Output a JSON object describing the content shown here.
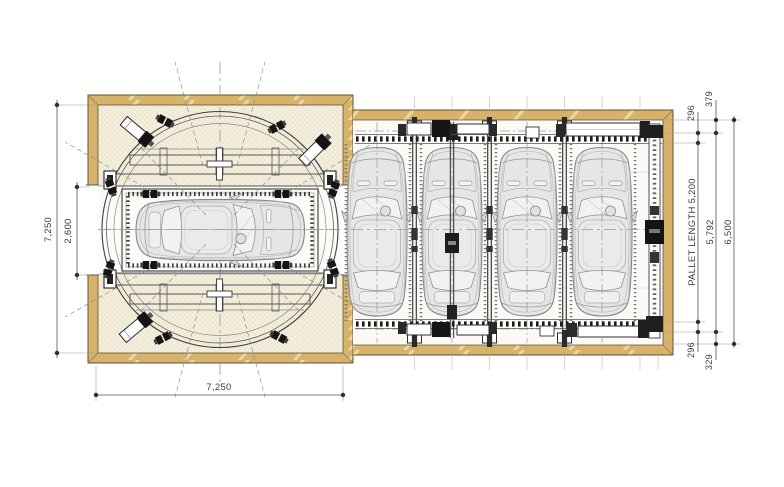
{
  "drawing": {
    "type": "parking-system-plan",
    "dimensions": {
      "left_overall": "7,250",
      "left_opening": "2,600",
      "bottom_overall": "7,250",
      "right_top_offset": "379",
      "right_top_gap": "296",
      "pallet_length": "PALLET LENGTH 5,200",
      "right_span": "5,792",
      "right_overall": "6,500",
      "right_bottom_gap": "296",
      "right_bottom_offset": "329"
    },
    "colors": {
      "wall": "#d7b26b",
      "wall_hatch": "#ecd7a4",
      "interior_cream": "#f3eedd",
      "interior_white": "#fbfaf7",
      "car_body": "#e6e6e4",
      "machinery_dark": "#1a1a1a",
      "dimension": "#3d3d3d"
    }
  }
}
